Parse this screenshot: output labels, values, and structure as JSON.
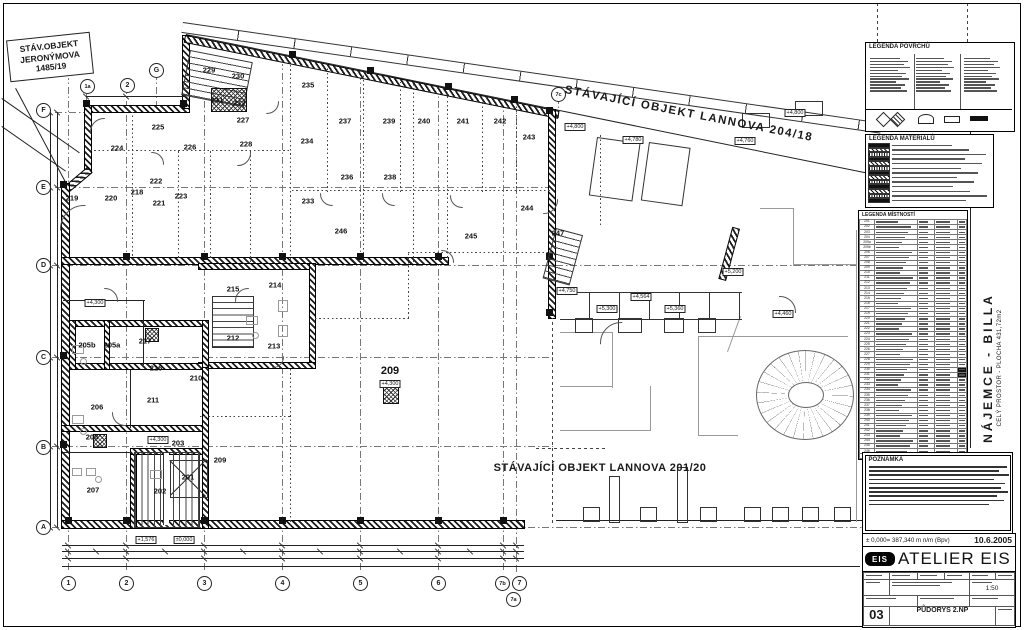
{
  "colors": {
    "line": "#1a1a1a",
    "gray": "#999999",
    "paper": "#ffffff"
  },
  "labels": {
    "jeronymova": [
      "STÁV.OBJEKT",
      "JERONÝMOVA",
      "1485/19"
    ],
    "lannova_top": "STÁVAJÍCÍ OBJEKT LANNOVA 204/18",
    "lannova_bottom": "STÁVAJÍCÍ OBJEKT LANNOVA 201/20",
    "najemce": "NÁJEMCE - BILLA",
    "najemce_sub": "CELÝ PROSTOR - PLOCHA 431,72m2"
  },
  "legend_titles": {
    "povrchu": "LEGENDA POVRCHŮ",
    "materialu": "LEGENDA MATERIÁLŮ",
    "mistnosti": "LEGENDA MÍSTNOSTÍ",
    "poznamka": "POZNÁMKA"
  },
  "titleblock": {
    "elevation_note": "± 0,000= 387,340 m n/m (Bpv)",
    "date": "10.6.2005",
    "logo_text": "EIS",
    "studio": "ATELIER EIS",
    "drawing_number": "03",
    "drawing_name": "PŮDORYS 2.NP",
    "scale": "1:50"
  },
  "grid_markers": {
    "top": [
      {
        "label": "1a",
        "x": 87,
        "y": 86
      },
      {
        "label": "2",
        "x": 127,
        "y": 85
      },
      {
        "label": "G",
        "x": 156,
        "y": 70
      },
      {
        "label": "7c",
        "x": 558,
        "y": 94
      }
    ],
    "left": [
      {
        "label": "F",
        "x": 43,
        "y": 110
      },
      {
        "label": "E",
        "x": 43,
        "y": 187
      },
      {
        "label": "D",
        "x": 43,
        "y": 265
      },
      {
        "label": "C",
        "x": 43,
        "y": 357
      },
      {
        "label": "B",
        "x": 43,
        "y": 447
      },
      {
        "label": "A",
        "x": 43,
        "y": 527
      }
    ],
    "bottom": [
      {
        "label": "1",
        "x": 68,
        "y": 583
      },
      {
        "label": "2",
        "x": 126,
        "y": 583
      },
      {
        "label": "3",
        "x": 204,
        "y": 583
      },
      {
        "label": "4",
        "x": 282,
        "y": 583
      },
      {
        "label": "5",
        "x": 360,
        "y": 583
      },
      {
        "label": "6",
        "x": 438,
        "y": 583
      },
      {
        "label": "7b",
        "x": 502,
        "y": 583
      },
      {
        "label": "7",
        "x": 519,
        "y": 583
      },
      {
        "label": "7a",
        "x": 513,
        "y": 599
      }
    ]
  },
  "rooms": [
    {
      "n": "219",
      "x": 72,
      "y": 198
    },
    {
      "n": "220",
      "x": 111,
      "y": 198
    },
    {
      "n": "218",
      "x": 137,
      "y": 192
    },
    {
      "n": "222",
      "x": 156,
      "y": 181
    },
    {
      "n": "221",
      "x": 159,
      "y": 203
    },
    {
      "n": "223",
      "x": 181,
      "y": 196
    },
    {
      "n": "224",
      "x": 117,
      "y": 148
    },
    {
      "n": "225",
      "x": 158,
      "y": 127
    },
    {
      "n": "226",
      "x": 190,
      "y": 147
    },
    {
      "n": "227",
      "x": 243,
      "y": 120
    },
    {
      "n": "228",
      "x": 246,
      "y": 144
    },
    {
      "n": "229",
      "x": 209,
      "y": 70
    },
    {
      "n": "230",
      "x": 238,
      "y": 76
    },
    {
      "n": "231",
      "x": 217,
      "y": 100
    },
    {
      "n": "232",
      "x": 239,
      "y": 103
    },
    {
      "n": "233",
      "x": 308,
      "y": 201
    },
    {
      "n": "234",
      "x": 307,
      "y": 141
    },
    {
      "n": "235",
      "x": 308,
      "y": 85
    },
    {
      "n": "236",
      "x": 347,
      "y": 177
    },
    {
      "n": "237",
      "x": 345,
      "y": 121
    },
    {
      "n": "238",
      "x": 390,
      "y": 177
    },
    {
      "n": "239",
      "x": 389,
      "y": 121
    },
    {
      "n": "240",
      "x": 424,
      "y": 121
    },
    {
      "n": "241",
      "x": 463,
      "y": 121
    },
    {
      "n": "242",
      "x": 500,
      "y": 121
    },
    {
      "n": "243",
      "x": 529,
      "y": 137
    },
    {
      "n": "244",
      "x": 527,
      "y": 208
    },
    {
      "n": "245",
      "x": 471,
      "y": 236
    },
    {
      "n": "246",
      "x": 341,
      "y": 231
    },
    {
      "n": "247",
      "x": 558,
      "y": 233
    },
    {
      "n": "215",
      "x": 233,
      "y": 289
    },
    {
      "n": "214",
      "x": 275,
      "y": 285
    },
    {
      "n": "212",
      "x": 233,
      "y": 338
    },
    {
      "n": "213",
      "x": 274,
      "y": 346
    },
    {
      "n": "217",
      "x": 145,
      "y": 341
    },
    {
      "n": "216",
      "x": 156,
      "y": 368
    },
    {
      "n": "210",
      "x": 196,
      "y": 378
    },
    {
      "n": "211",
      "x": 153,
      "y": 400
    },
    {
      "n": "206",
      "x": 97,
      "y": 407
    },
    {
      "n": "205b",
      "x": 87,
      "y": 345
    },
    {
      "n": "205a",
      "x": 112,
      "y": 345
    },
    {
      "n": "208",
      "x": 92,
      "y": 437
    },
    {
      "n": "203",
      "x": 178,
      "y": 443
    },
    {
      "n": "209",
      "x": 390,
      "y": 371,
      "big": true
    },
    {
      "n": "209",
      "x": 220,
      "y": 460
    },
    {
      "n": "201",
      "x": 188,
      "y": 477
    },
    {
      "n": "202",
      "x": 160,
      "y": 491
    },
    {
      "n": "207",
      "x": 93,
      "y": 490
    }
  ],
  "elevations": [
    {
      "t": "+4,300",
      "x": 390,
      "y": 384
    },
    {
      "t": "+4,300",
      "x": 158,
      "y": 440
    },
    {
      "t": "+4,300",
      "x": 95,
      "y": 303
    },
    {
      "t": "+4,750",
      "x": 567,
      "y": 291
    },
    {
      "t": "+4,564",
      "x": 641,
      "y": 297
    },
    {
      "t": "+5,200",
      "x": 733,
      "y": 272
    },
    {
      "t": "+5,360",
      "x": 675,
      "y": 309
    },
    {
      "t": "+5,300",
      "x": 607,
      "y": 309
    },
    {
      "t": "+4,460",
      "x": 783,
      "y": 314
    },
    {
      "t": "+4,800",
      "x": 795,
      "y": 113
    },
    {
      "t": "+4,800",
      "x": 575,
      "y": 127
    },
    {
      "t": "+4,780",
      "x": 633,
      "y": 140
    },
    {
      "t": "+4,760",
      "x": 745,
      "y": 141
    },
    {
      "t": "+1,576",
      "x": 146,
      "y": 540
    },
    {
      "t": "±0,000",
      "x": 184,
      "y": 540
    }
  ],
  "mistnosti_rows": [
    "201",
    "202",
    "203",
    "204",
    "205a",
    "205b",
    "206",
    "207",
    "208",
    "209",
    "210",
    "211",
    "212",
    "213",
    "214",
    "215",
    "216",
    "217",
    "219",
    "220",
    "221",
    "222",
    "223",
    "224",
    "225",
    "226",
    "227",
    "228",
    "229",
    "230",
    "231",
    "232",
    "233",
    "234",
    "235",
    "236",
    "237",
    "238",
    "239",
    "240",
    "241",
    "242",
    "243",
    "244",
    "245",
    "246",
    "247"
  ]
}
